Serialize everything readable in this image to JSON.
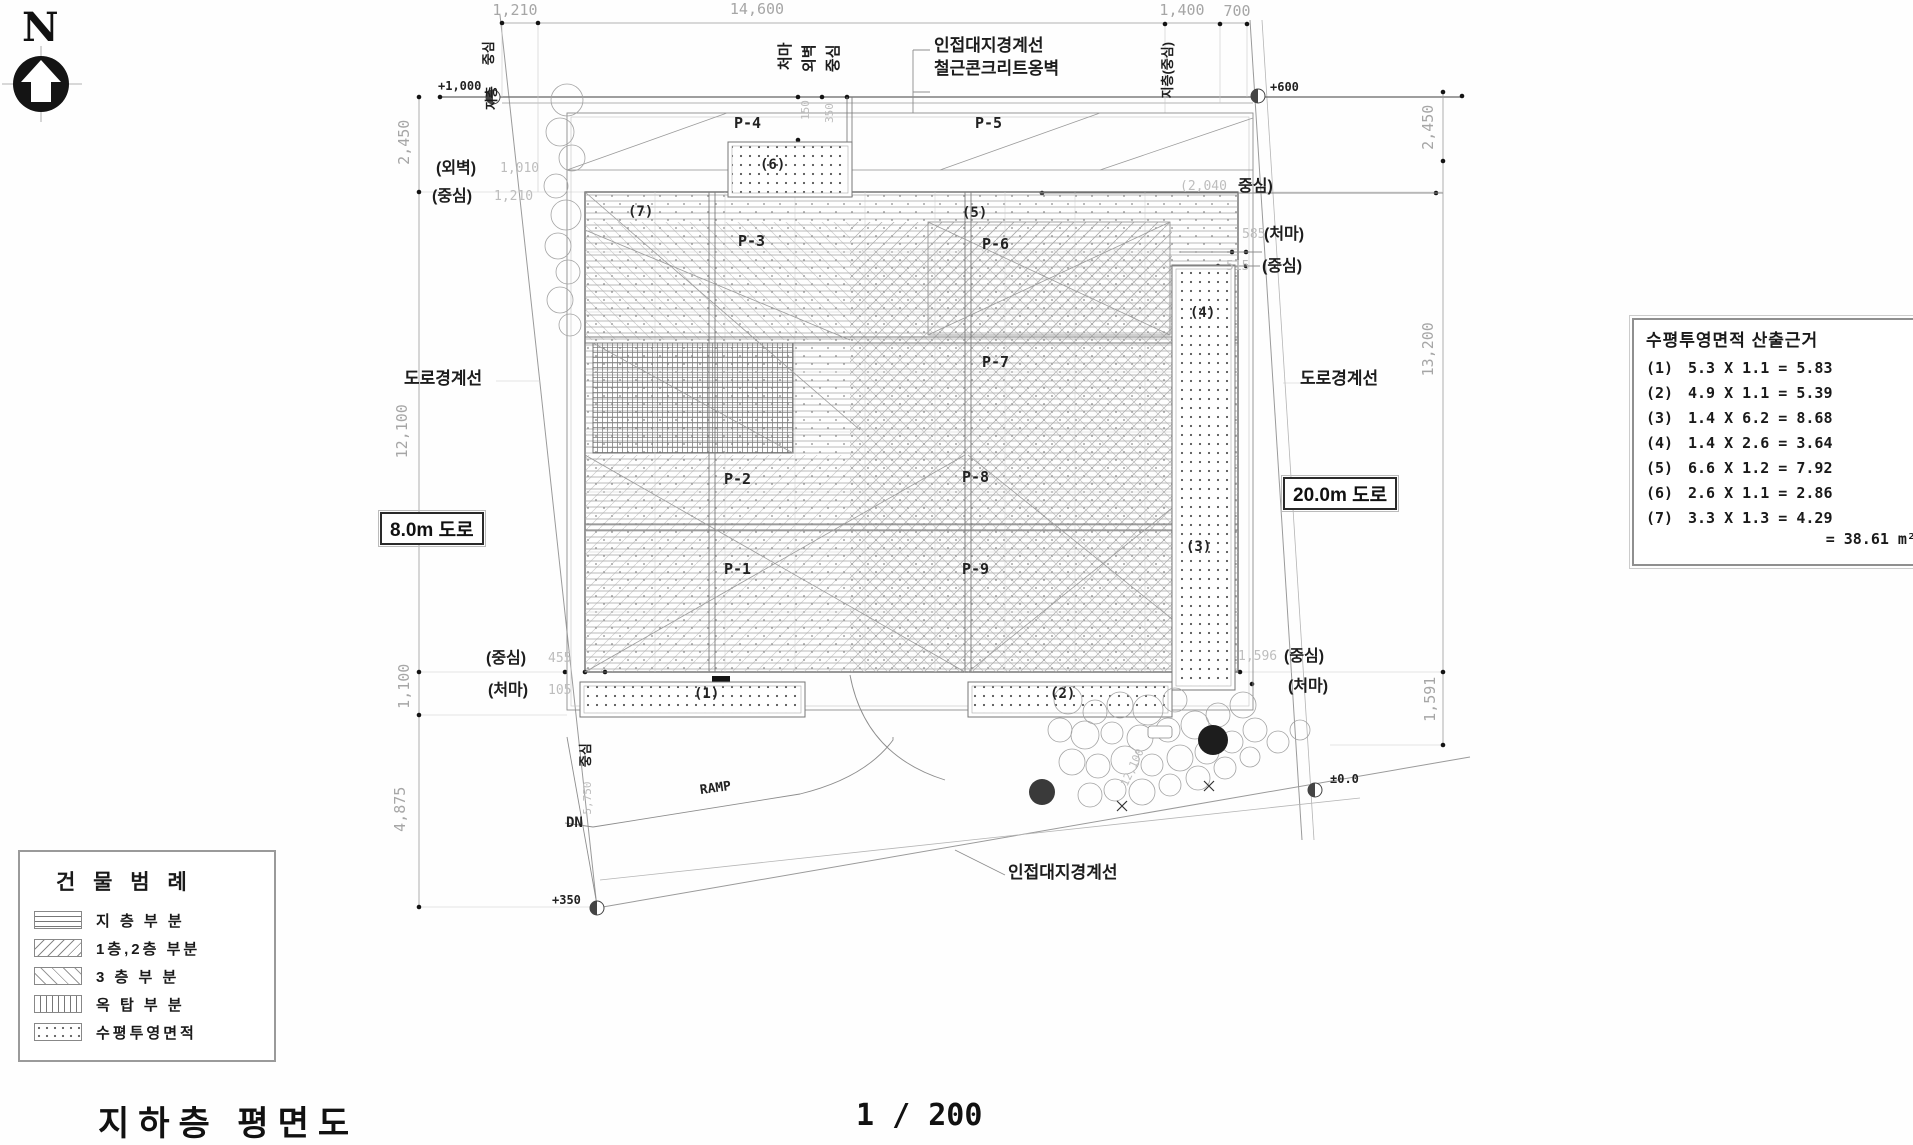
{
  "style": {
    "ink": "#1a1a1a",
    "dim_gray": "#a6a6a6",
    "line_gray": "#999999"
  },
  "compass": {
    "n": "N"
  },
  "sheet": {
    "title": "지하층 평면도",
    "scale": "1 / 200"
  },
  "top_labels": {
    "adjacent_boundary": "인접대지경계선",
    "retaining_wall": "철근콘크리트옹벽"
  },
  "bottom_labels": {
    "adjacent_boundary": "인접대지경계선"
  },
  "roads": {
    "left_boundary": "도로경계선",
    "right_boundary": "도로경계선",
    "left_road": "8.0m 도로",
    "right_road": "20.0m 도로"
  },
  "dims": {
    "top": [
      "1,210",
      "14,600",
      "1,400",
      "700"
    ],
    "left": [
      "2,450",
      "12,100",
      "1,100",
      "4,875"
    ],
    "right": [
      "2,450",
      "13,200",
      "1,591"
    ]
  },
  "levels": {
    "tl": "+1,000",
    "tr": "+600",
    "bl": "+350",
    "br": "±0.0"
  },
  "wall_marks": {
    "left_outer": "(외벽)",
    "left_outer_dim": "1,010",
    "left_center": "(중심)",
    "left_center_dim": "1,210",
    "bl_center": "(중심)",
    "bl_center_dim": "455",
    "bl_eave": "(처마)",
    "bl_eave_dim": "105",
    "br_center": "(중심)",
    "br_center_dim": "1,596",
    "br_eave": "(처마)",
    "tr_center1": "중심)",
    "tr_center1_dim": "(2,040",
    "tr_eave": "(처마)",
    "tr_eave_dim": "585",
    "tr_center2": "(중심)",
    "tr_center2_dim": "515",
    "rot_eave": "처마",
    "rot_outer": "외벽",
    "rot_center": "중심",
    "rot_dim_150": "150",
    "rot_dim_350": "350",
    "tl_rot": "중심",
    "tl_rot2": "지층",
    "tr_rot": "지층(중심)",
    "ramp_rot_center": "중심",
    "ramp_rot_dim": "5,750",
    "tree_dim": "12,100"
  },
  "plan": {
    "p": [
      "P-1",
      "P-2",
      "P-3",
      "P-4",
      "P-5",
      "P-6",
      "P-7",
      "P-8",
      "P-9"
    ],
    "areas": [
      "(1)",
      "(2)",
      "(3)",
      "(4)",
      "(5)",
      "(6)",
      "(7)"
    ],
    "ramp": "RAMP",
    "dn": "DN"
  },
  "calc": {
    "title": "수평투영면적 산출근거",
    "rows": [
      {
        "no": "(1)",
        "eq": "5.3 X 1.1 = 5.83"
      },
      {
        "no": "(2)",
        "eq": "4.9 X 1.1 = 5.39"
      },
      {
        "no": "(3)",
        "eq": "1.4 X 6.2 = 8.68"
      },
      {
        "no": "(4)",
        "eq": "1.4 X 2.6 = 3.64"
      },
      {
        "no": "(5)",
        "eq": "6.6 X 1.2 = 7.92"
      },
      {
        "no": "(6)",
        "eq": "2.6 X 1.1 = 2.86"
      },
      {
        "no": "(7)",
        "eq": "3.3 X 1.3 = 4.29"
      }
    ],
    "total": "= 38.61 m²"
  },
  "legend": {
    "title": "건 물 범 례",
    "items": [
      {
        "label": "지 층 부 분",
        "hatch": "horizontal-lines"
      },
      {
        "label": "1층,2층 부분",
        "hatch": "diagonal-forward"
      },
      {
        "label": "3 층 부 분",
        "hatch": "diagonal-back"
      },
      {
        "label": "옥 탑 부 분",
        "hatch": "vertical-lines"
      },
      {
        "label": "수평투영면적",
        "hatch": "dots"
      }
    ]
  }
}
